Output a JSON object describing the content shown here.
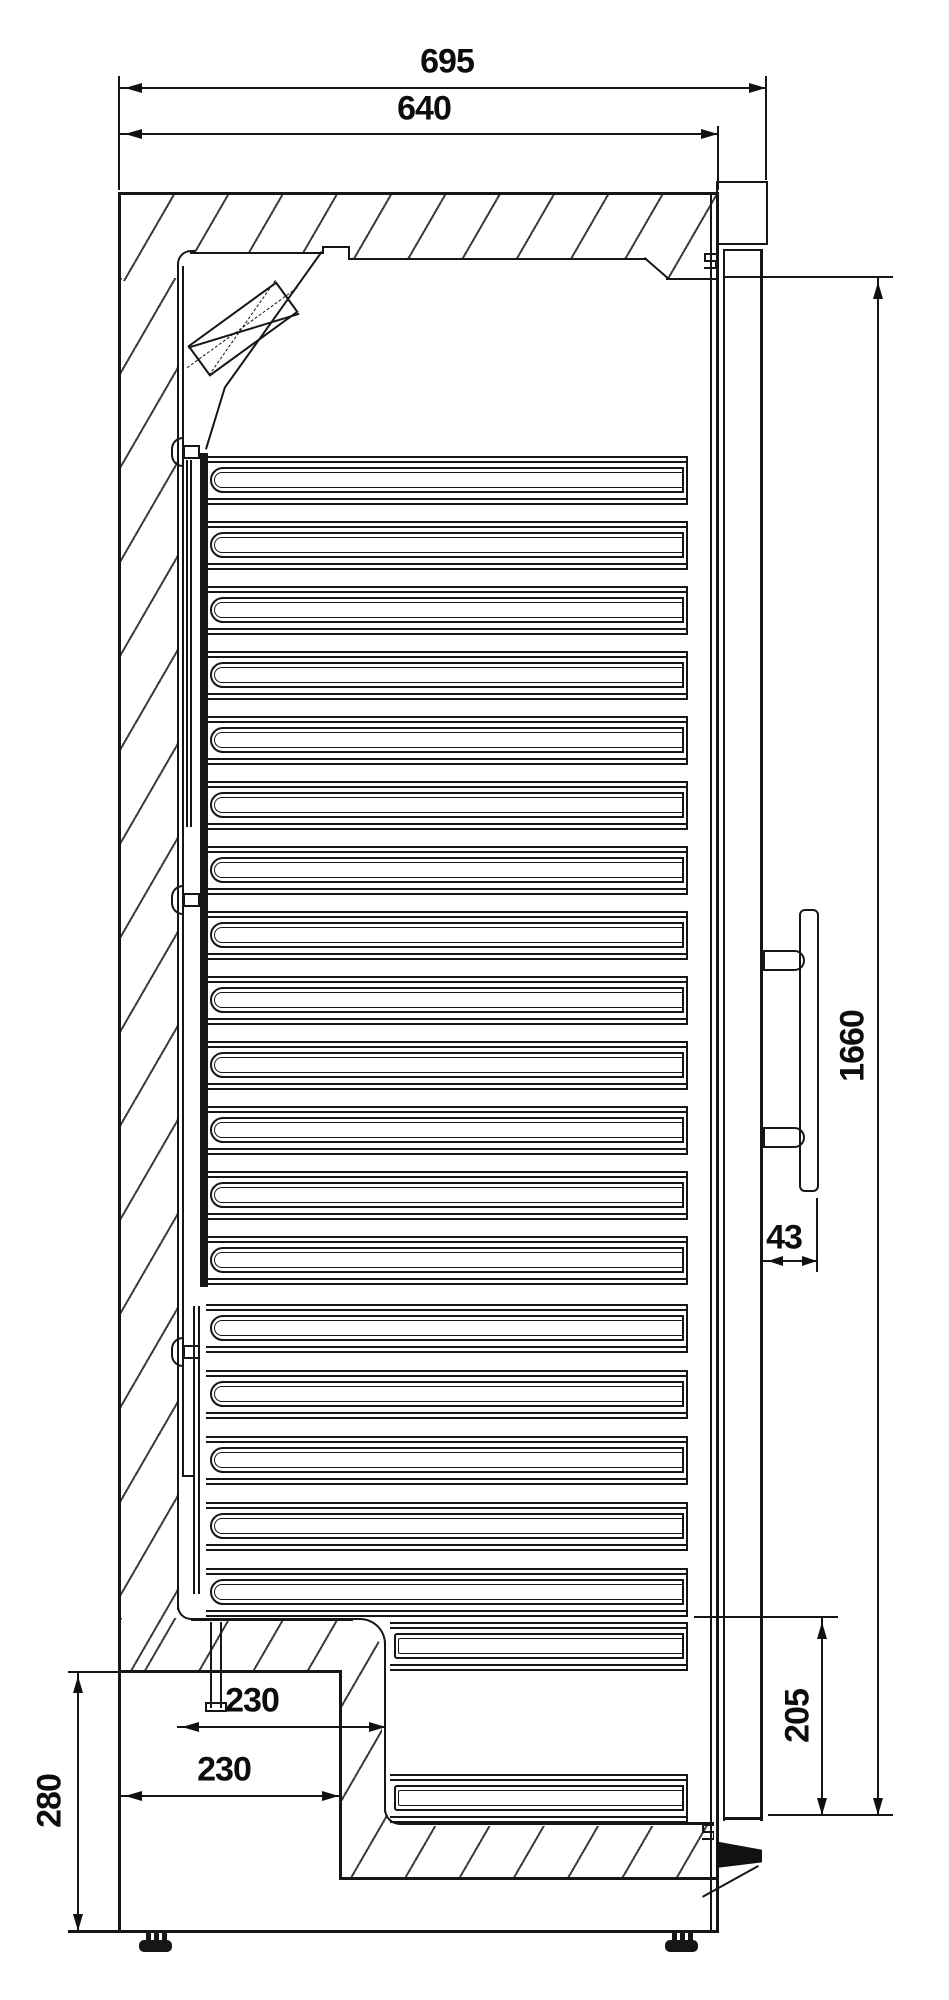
{
  "drawing": {
    "title": "refrigerator-side-section",
    "dims": {
      "overall_depth": "695",
      "body_depth": "640",
      "door_height": "1660",
      "handle_standoff": "43",
      "bottom_recess_height": "205",
      "compartment_height": "280",
      "compartment_depth_inner": "230",
      "compartment_depth_outer": "230"
    },
    "counts": {
      "shelves_upper": 13,
      "shelves_lower": 5,
      "shelves_recess": 2
    }
  }
}
